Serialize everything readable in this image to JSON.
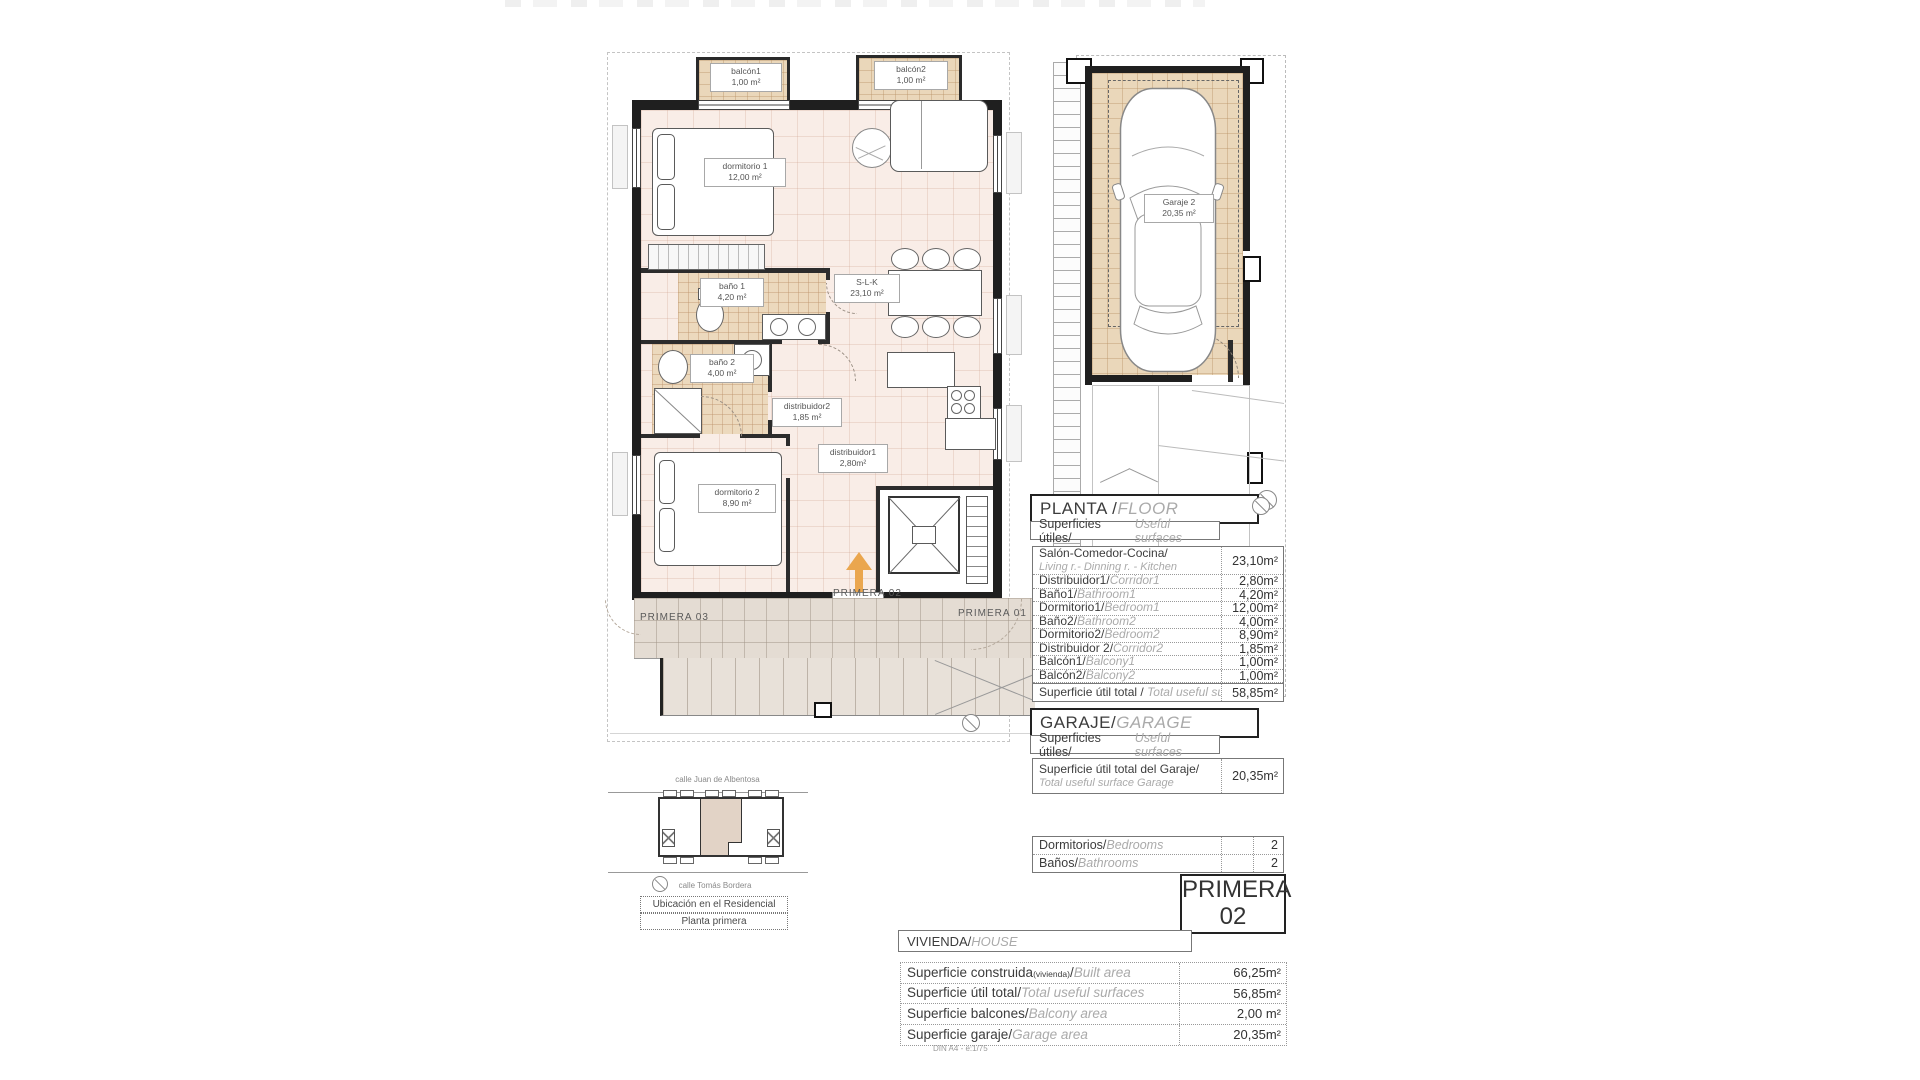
{
  "colors": {
    "floor_pink": "#f9ede7",
    "tile_tan": "#ead7ba",
    "accent_orange": "#eaa64e"
  },
  "plan": {
    "labels": {
      "balcon1": {
        "name": "balcón1",
        "area": "1,00 m²"
      },
      "balcon2": {
        "name": "balcón2",
        "area": "1,00 m²"
      },
      "dormitorio1": {
        "name": "dormitorio 1",
        "area": "12,00 m²"
      },
      "slk": {
        "name": "S-L-K",
        "area": "23,10 m²"
      },
      "bano1": {
        "name": "baño 1",
        "area": "4,20 m²"
      },
      "bano2": {
        "name": "baño 2",
        "area": "4,00 m²"
      },
      "distribuidor2": {
        "name": "distribuidor2",
        "area": "1,85 m²"
      },
      "dormitorio2": {
        "name": "dormitorio 2",
        "area": "8,90 m²"
      },
      "distribuidor1": {
        "name": "distribuidor1",
        "area": "2,80m²"
      },
      "garaje": {
        "name": "Garaje 2",
        "area": "20,35 m²"
      }
    },
    "landing": {
      "left": "PRIMERA 03",
      "center": "PRIMERA 02",
      "right": "PRIMERA 01"
    }
  },
  "planta_table": {
    "title": "PLANTA / ",
    "title_en": "FLOOR",
    "subtitle": "Superficies útiles/",
    "subtitle_en": "Useful surfaces",
    "rows": [
      {
        "es": "Salón-Comedor-Cocina/",
        "en": "Living r.- Dinning r. - Kitchen",
        "value": "23,10m²"
      },
      {
        "es": "Distribuidor1/",
        "en": "Corridor1",
        "value": "2,80m²"
      },
      {
        "es": "Baño1/",
        "en": "Bathroom1",
        "value": "4,20m²"
      },
      {
        "es": "Dormitorio1/",
        "en": "Bedroom1",
        "value": "12,00m²"
      },
      {
        "es": "Baño2/",
        "en": "Bathroom2",
        "value": "4,00m²"
      },
      {
        "es": "Dormitorio2/",
        "en": "Bedroom2",
        "value": "8,90m²"
      },
      {
        "es": "Distribuidor 2/",
        "en": "Corridor2",
        "value": "1,85m²"
      },
      {
        "es": "Balcón1/",
        "en": "Balcony1",
        "value": "1,00m²"
      },
      {
        "es": "Balcón2/",
        "en": "Balcony2",
        "value": "1,00m²"
      }
    ],
    "total": {
      "es": "Superficie útil total / ",
      "en": "Total useful surface",
      "value": "58,85m²"
    }
  },
  "garaje_table": {
    "title": "GARAJE/",
    "title_en": "GARAGE",
    "subtitle": "Superficies útiles/",
    "subtitle_en": "Useful surfaces",
    "row": {
      "es": "Superficie útil total del Garaje/",
      "en": "Total useful surface Garage",
      "value": "20,35m²"
    }
  },
  "counts_table": {
    "rows": [
      {
        "es": "Dormitorios/",
        "en": "Bedrooms",
        "value": "2"
      },
      {
        "es": "Baños/",
        "en": "Bathrooms",
        "value": "2"
      }
    ]
  },
  "unit_badge": {
    "line1": "PRIMERA",
    "line2": "02"
  },
  "vivienda_table": {
    "title": "VIVIENDA/",
    "title_en": "HOUSE",
    "rows": [
      {
        "es": "Superficie construida",
        "sub": "(vivienda)",
        "sep": "/",
        "en": "Built area",
        "value": "66,25m²"
      },
      {
        "es": "Superficie útil total",
        "sub": "",
        "sep": "/",
        "en": "Total useful surfaces",
        "value": "56,85m²"
      },
      {
        "es": "Superficie balcones",
        "sub": "",
        "sep": "/",
        "en": "Balcony area",
        "value": "2,00 m²"
      },
      {
        "es": "Superficie garaje",
        "sub": "",
        "sep": "/",
        "en": "Garage area",
        "value": "20,35m²"
      }
    ]
  },
  "location_map": {
    "street_top": "calle Juan de Albentosa",
    "street_bottom": "calle Tomás Bordera",
    "caption_line1": "Ubicación en el Residencial",
    "caption_line2": "Planta primera"
  },
  "footer_note": "DIN A4 - e:1/75"
}
